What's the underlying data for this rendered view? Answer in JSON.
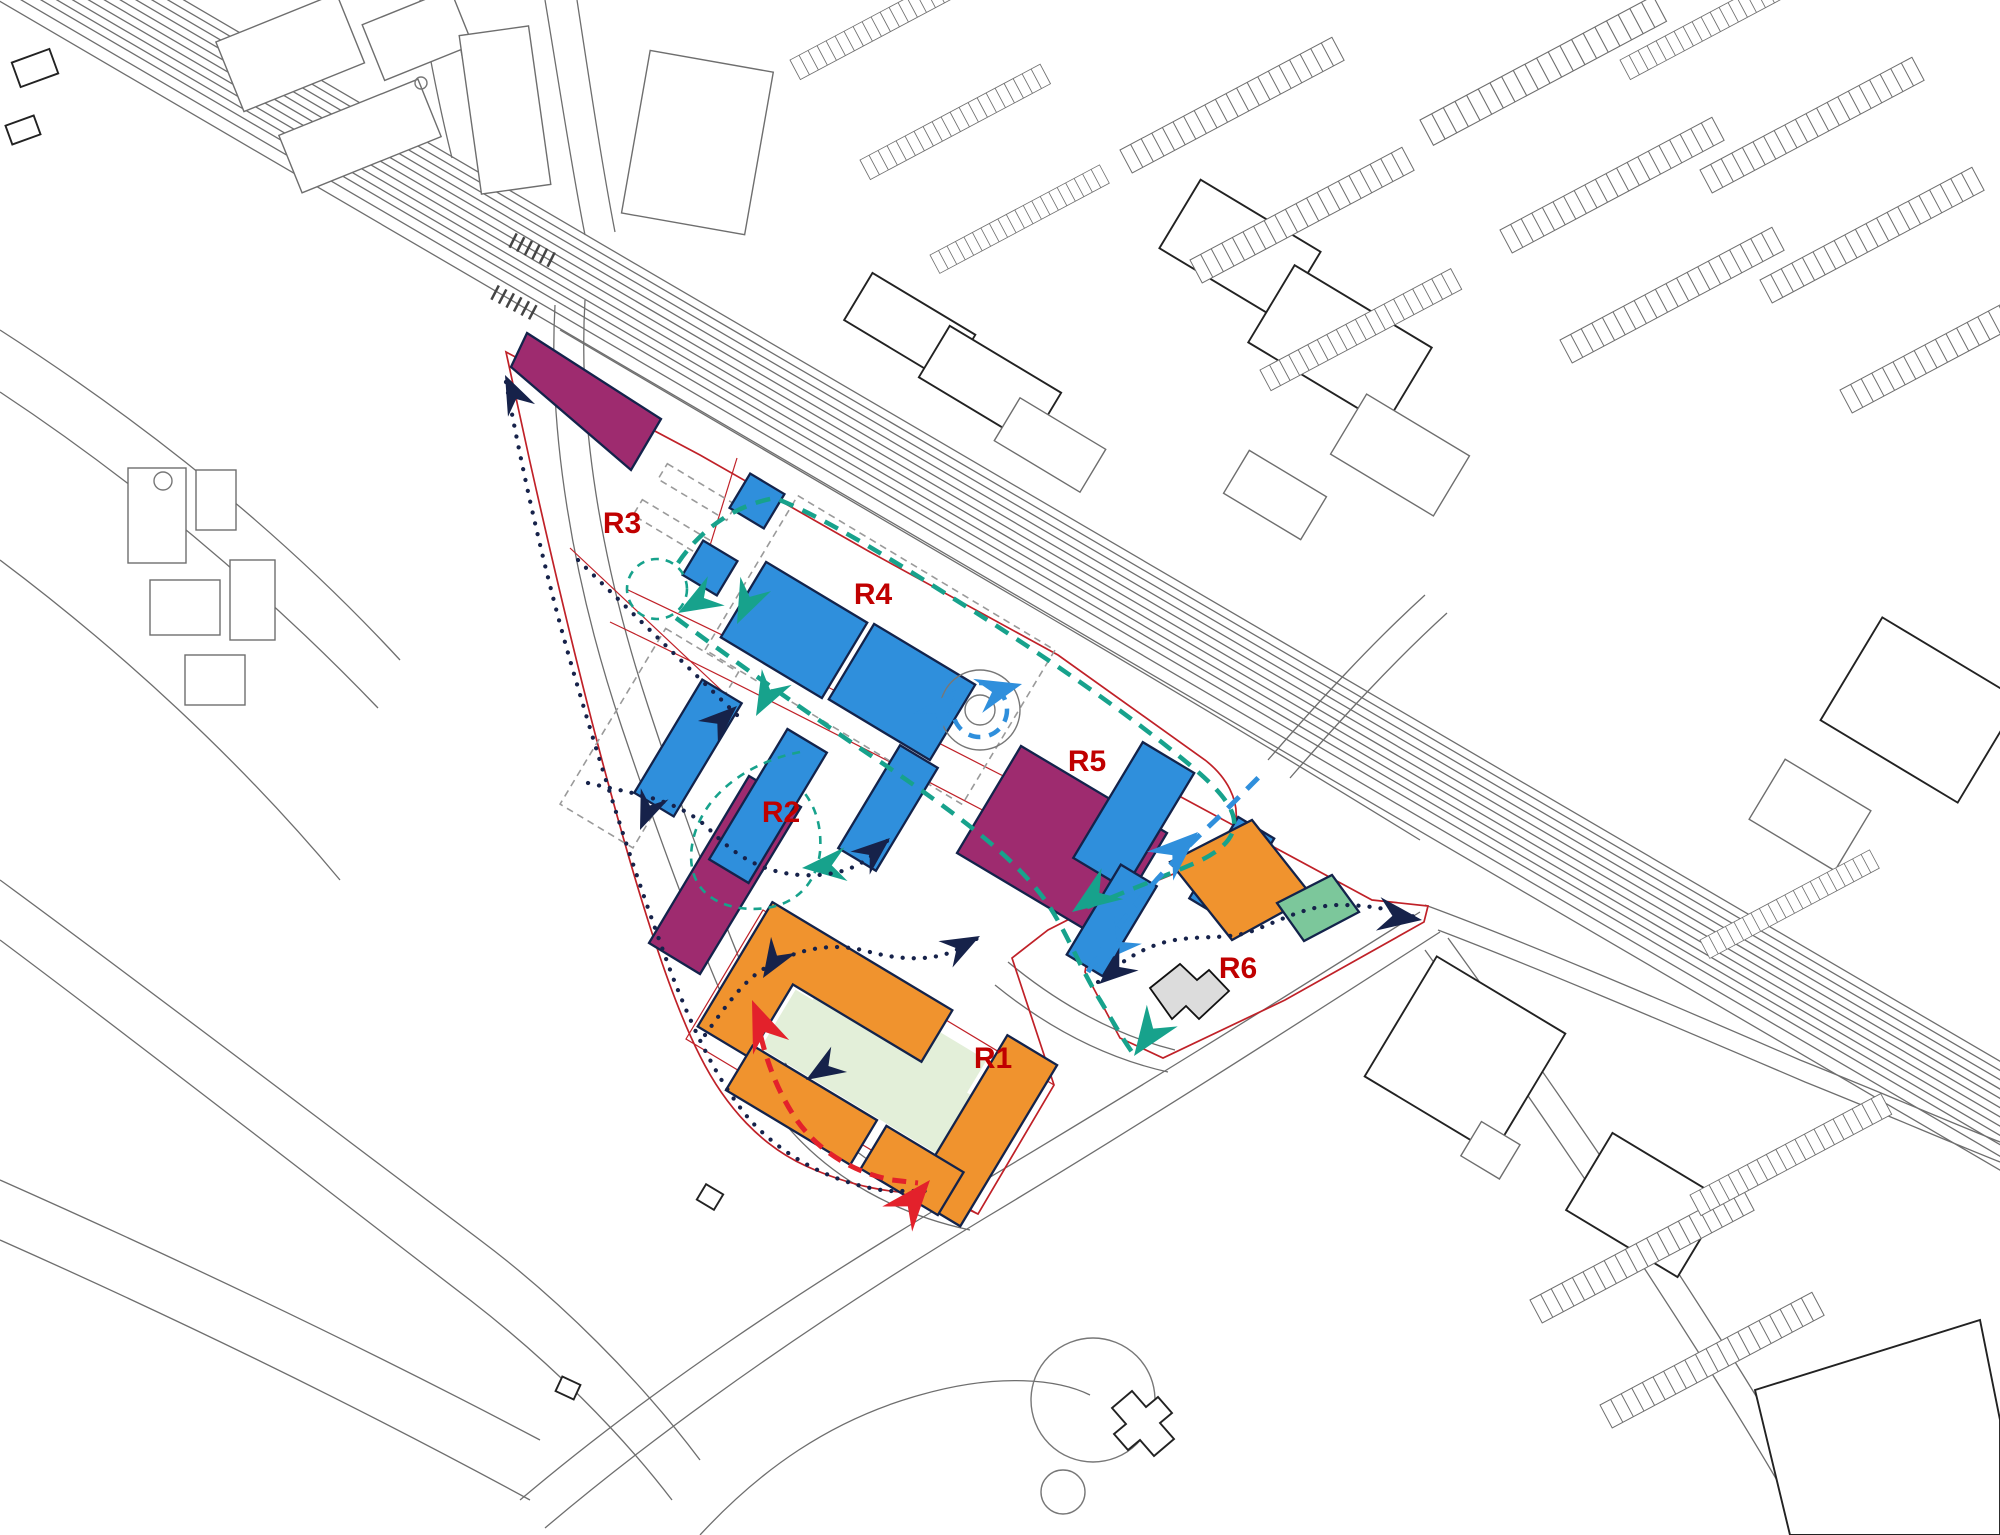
{
  "parcels": [
    {
      "id": "r1",
      "label": "R1"
    },
    {
      "id": "r2",
      "label": "R2"
    },
    {
      "id": "r3",
      "label": "R3"
    },
    {
      "id": "r4",
      "label": "R4"
    },
    {
      "id": "r5",
      "label": "R5"
    },
    {
      "id": "r6",
      "label": "R6"
    }
  ],
  "label_color": "#C00000",
  "colors": {
    "parcel_blue": "#2F8FDC",
    "parcel_purple": "#9E2B6F",
    "parcel_orange": "#F0932E",
    "parcel_green": "#7CC79B",
    "courtyard_green": "#E3EFD9",
    "existing_building_grey": "#DCDCDC",
    "route_teal": "#17A28C",
    "route_navy": "#16224A",
    "route_red": "#E3212B",
    "route_blue": "#2F8FDC",
    "boundary_red": "#C02128",
    "basemap_grey": "#6E6E6E"
  }
}
